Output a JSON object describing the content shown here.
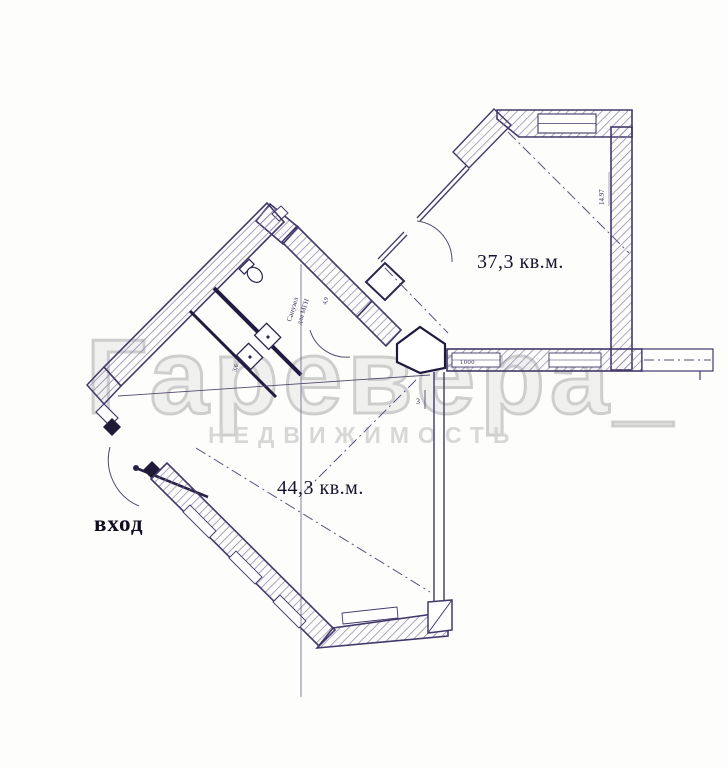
{
  "watermark": {
    "line1": "Гаревера_",
    "line2": "НЕДВИЖИМОСТЬ"
  },
  "rooms": {
    "room1_area": "37,3 кв.м.",
    "room2_area": "44,3 кв.м."
  },
  "labels": {
    "entrance": "вход",
    "bathroom_line1": "Санузел",
    "bathroom_line2": "для МГН"
  },
  "dimensions": {
    "right_wall": "14.97",
    "window_width": "1000",
    "bathroom_area": "4,9",
    "hall_dim": "3,6",
    "wall_mark": "3"
  },
  "colors": {
    "ink": "#43386a",
    "hatch": "#8a7fa8",
    "black": "#201a38",
    "watermark_big": "#c3c3c3",
    "watermark_small": "#d3d3d3"
  }
}
